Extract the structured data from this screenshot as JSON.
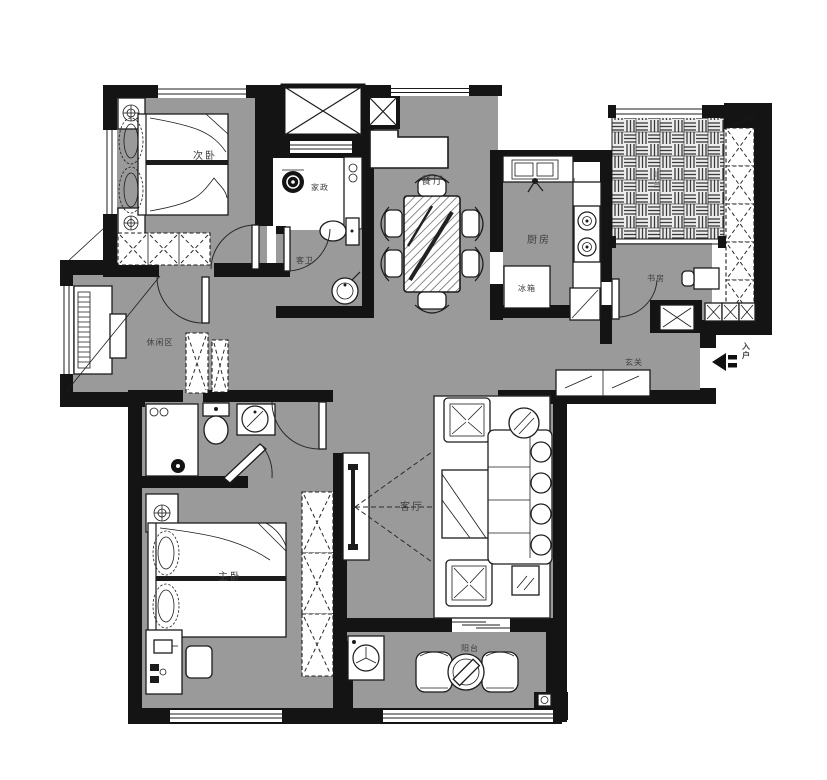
{
  "colors": {
    "floor_gray": "#9a9a9a",
    "wall_black": "#141414",
    "paper_white": "#ffffff",
    "furniture_line": "#1c1c1c",
    "label_gray": "#3f3f3f"
  },
  "rooms": {
    "secondary_bedroom": {
      "label": "次卧"
    },
    "laundry": {
      "label": "家政"
    },
    "guest_bathroom": {
      "label": "客卫"
    },
    "dining_room": {
      "label": "餐厅"
    },
    "kitchen": {
      "label": "厨房"
    },
    "refrigerator": {
      "label": "冰箱"
    },
    "service_balcony": {
      "label": "阳台"
    },
    "study": {
      "label": "书房"
    },
    "foyer": {
      "label": "玄关"
    },
    "entry": {
      "label": "入户"
    },
    "living_room": {
      "label": "客厅"
    },
    "master_bedroom": {
      "label": "主卧"
    },
    "balcony": {
      "label": "阳台"
    },
    "leisure_area": {
      "label": "休闲区"
    }
  }
}
